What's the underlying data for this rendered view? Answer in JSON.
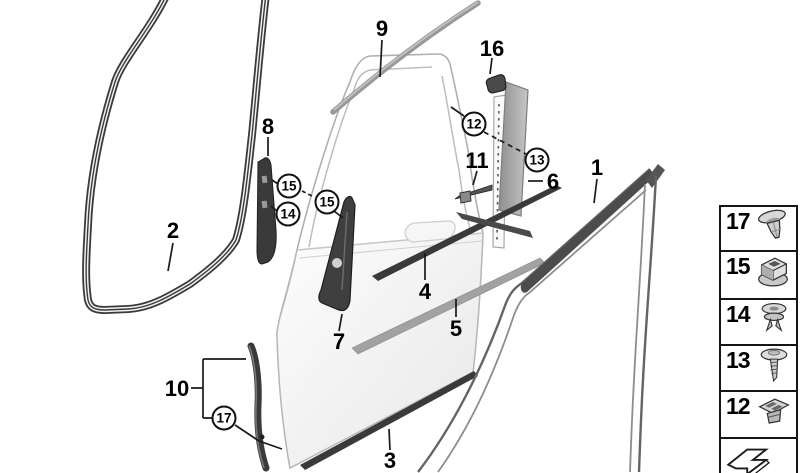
{
  "figure": {
    "kind": "exploded-parts-diagram",
    "subject": "front door trims, seals and fastener clips",
    "background": "#ffffff",
    "line_color": "#1a1a1a",
    "part_dark": "#3a3a3a",
    "part_gray": "#9e9e9e"
  },
  "diagram": {
    "part_labels": [
      {
        "text": "9",
        "x": 382,
        "y": 28,
        "circled": false
      },
      {
        "text": "16",
        "x": 492,
        "y": 48,
        "circled": false
      },
      {
        "text": "8",
        "x": 268,
        "y": 126,
        "circled": false
      },
      {
        "text": "2",
        "x": 173,
        "y": 230,
        "circled": false
      },
      {
        "text": "11",
        "x": 477,
        "y": 160,
        "circled": false
      },
      {
        "text": "6",
        "x": 553,
        "y": 181,
        "circled": false
      },
      {
        "text": "1",
        "x": 597,
        "y": 167,
        "circled": false
      },
      {
        "text": "7",
        "x": 339,
        "y": 341,
        "circled": false
      },
      {
        "text": "4",
        "x": 425,
        "y": 291,
        "circled": false
      },
      {
        "text": "5",
        "x": 456,
        "y": 328,
        "circled": false
      },
      {
        "text": "10",
        "x": 177,
        "y": 388,
        "circled": false
      },
      {
        "text": "3",
        "x": 390,
        "y": 460,
        "circled": false
      },
      {
        "text": "12",
        "x": 474,
        "y": 124,
        "circled": true
      },
      {
        "text": "13",
        "x": 537,
        "y": 160,
        "circled": true
      },
      {
        "text": "15",
        "x": 289,
        "y": 186,
        "circled": true
      },
      {
        "text": "15",
        "x": 327,
        "y": 202,
        "circled": true
      },
      {
        "text": "14",
        "x": 288,
        "y": 214,
        "circled": true
      },
      {
        "text": "17",
        "x": 224,
        "y": 418,
        "circled": true
      }
    ]
  },
  "legend": {
    "items": [
      {
        "label": "17",
        "icon": "expanding-rivet-icon"
      },
      {
        "label": "15",
        "icon": "square-grommet-icon"
      },
      {
        "label": "14",
        "icon": "push-rivet-icon"
      },
      {
        "label": "13",
        "icon": "washer-screw-icon"
      },
      {
        "label": "12",
        "icon": "clip-grommet-icon"
      },
      {
        "label": "",
        "icon": "direction-arrow-icon"
      }
    ]
  }
}
